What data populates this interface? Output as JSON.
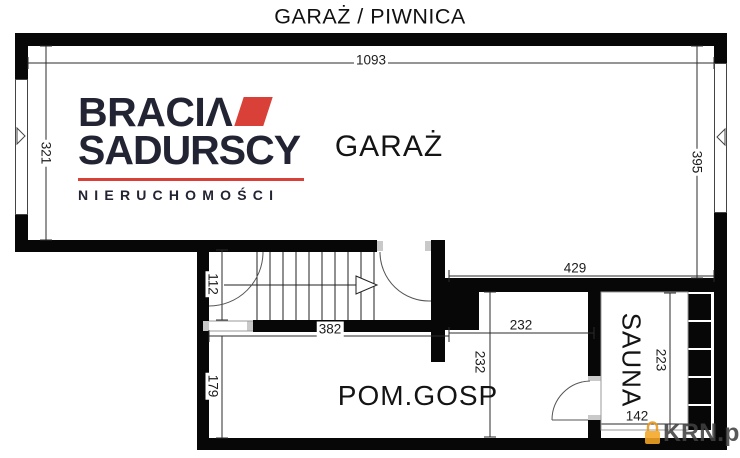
{
  "title": "GARAŻ / PIWNICA",
  "logo": {
    "word1": "BRACIΛ",
    "word2": "SADURSCY",
    "word3": "NIERUCHOMOŚCI",
    "accent_color": "#d94138",
    "text_color": "#232433",
    "roof_icon": "roof-shape"
  },
  "rooms": {
    "garage": "GARAŻ",
    "utility": "POM.GOSP",
    "sauna": "SAUNA"
  },
  "dims": {
    "garage_width": "1093",
    "garage_left_height": "321",
    "garage_right_height": "395",
    "garage_bottom_width": "429",
    "stair_height": "112",
    "stair_width": "382",
    "utility_height": "179",
    "mid_room_width": "232",
    "mid_room_height": "232",
    "sauna_height": "223",
    "sauna_width": "142"
  },
  "watermark": {
    "text": "KRN.pl",
    "icon": "krn-padlock-icon",
    "icon_color": "#f5a623"
  }
}
